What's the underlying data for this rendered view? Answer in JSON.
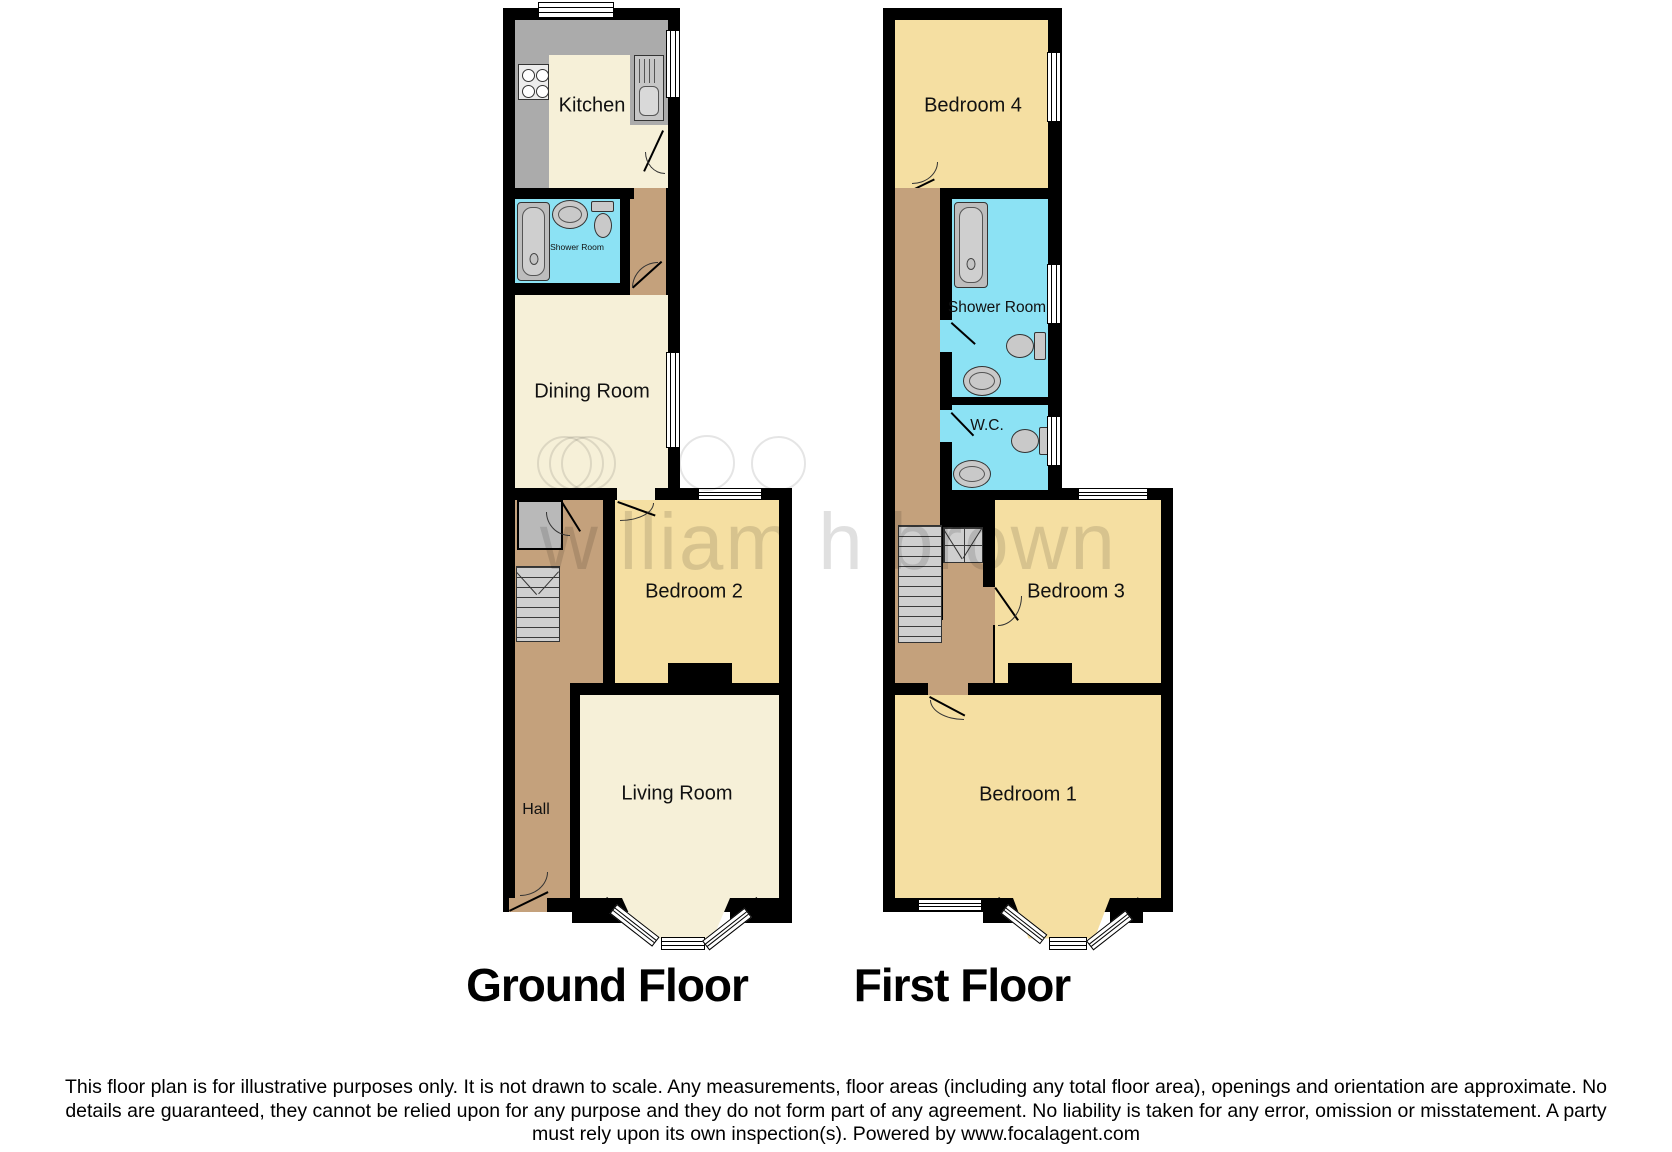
{
  "watermark": {
    "text": "william h brown"
  },
  "ground_floor": {
    "title": "Ground Floor",
    "rooms": {
      "kitchen": "Kitchen",
      "shower_room": "Shower Room",
      "dining_room": "Dining Room",
      "bedroom2": "Bedroom 2",
      "living_room": "Living Room",
      "hall": "Hall"
    }
  },
  "first_floor": {
    "title": "First Floor",
    "rooms": {
      "bedroom4": "Bedroom 4",
      "shower_room": "Shower Room",
      "wc": "W.C.",
      "bedroom3": "Bedroom 3",
      "bedroom1": "Bedroom 1"
    }
  },
  "disclaimer": {
    "line1": "This floor plan is for illustrative purposes only. It is not drawn to scale. Any measurements, floor areas (including any total floor area), openings and orientation are approximate. No",
    "line2": "details are guaranteed, they cannot be relied upon for any purpose and they do not form part of any agreement. No liability is taken for any error, omission or misstatement. A party",
    "line3": "must rely upon its own inspection(s). Powered by www.focalagent.com"
  },
  "colors": {
    "wall": "#000000",
    "cream": "#f6f0d8",
    "yellow": "#f5dfa2",
    "blue": "#8ce2f4",
    "tan": "#c4a17c",
    "counter": "#ababab",
    "fixture": "#c6c6c6",
    "stairs": "#cfcfcf"
  }
}
